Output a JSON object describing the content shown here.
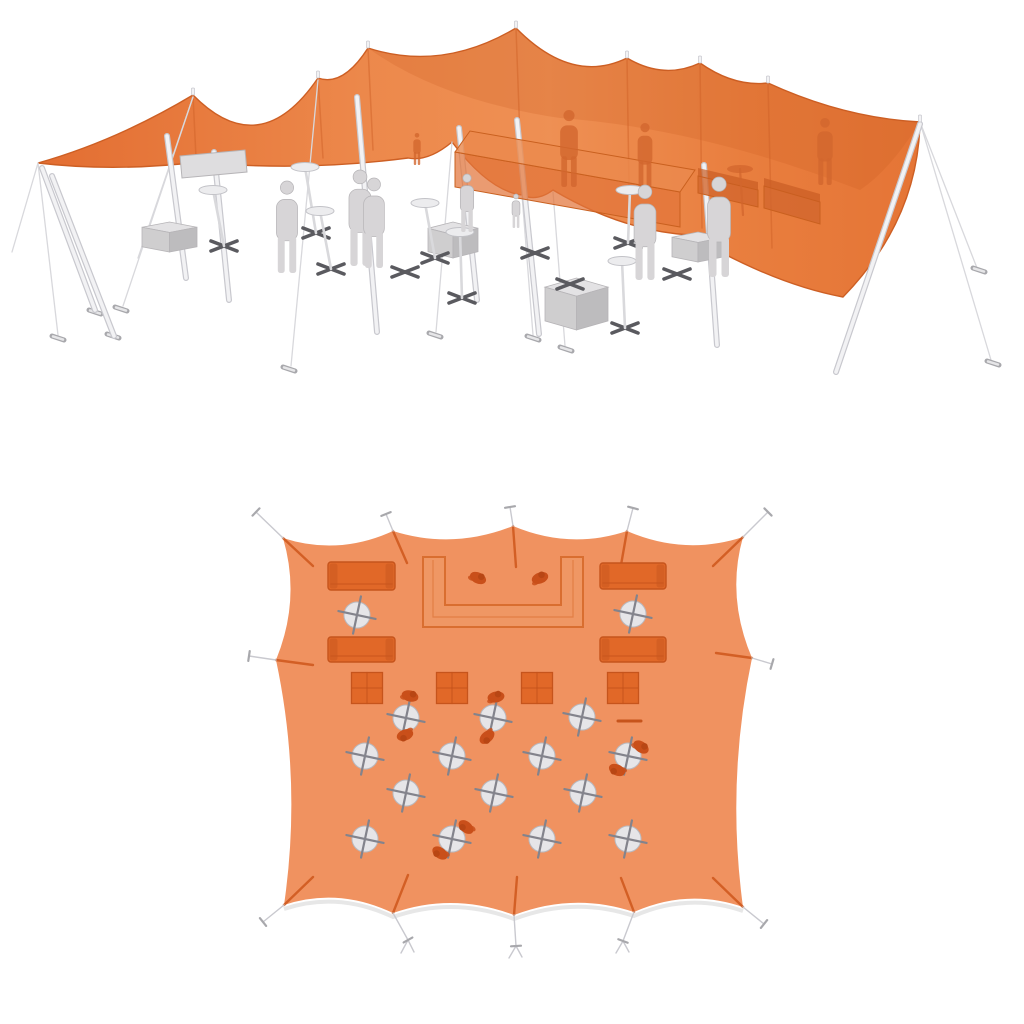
{
  "page": {
    "title": "stretch-tent-renders",
    "background": "#ffffff"
  },
  "colors": {
    "canopy_left": "#e2692b",
    "canopy_mid": "#ee8a4a",
    "canopy_right": "#e87b3a",
    "canopy_edge": "#cd5f24",
    "canopy_band": "#c85c20",
    "fold": "#cf6228",
    "pole_light": "#f2f2f4",
    "pole_dark": "#c8c8ce",
    "rope": "#d8d8dc",
    "stake_dark": "#a8a8ac",
    "stake_light": "#e6e6e8",
    "figure_fill": "#d7d5d7",
    "figure_edge": "#b6b4b7",
    "tint_fill": "#d2662e",
    "table_top": "#ececee",
    "table_edge": "#c2c2c7",
    "xbase": "#5a5a5f",
    "cube_top": "#e3e2e4",
    "cube_front": "#cfcecf",
    "cube_side": "#bdbcbe",
    "bench_fill": "#dedddf",
    "bar_fill": "#e2753a",
    "bar_edge": "#c9601f",
    "plan_fabric": "#f09260",
    "plan_fabric_shadow": "#d7d7d7",
    "plan_furniture": "#e16828",
    "plan_furniture_dark": "#c6541c",
    "plan_person": "#c94f1a",
    "plan_person_dark": "#b84614",
    "plan_table_top": "#e6e5e8",
    "plan_table_edge": "#b9b9bf",
    "plan_cross": "#83838c",
    "plan_seam": "#cf5a1f",
    "plan_rope": "#c9c9cf",
    "plan_ubar_fill": "#ef9764",
    "plan_ubar_edge": "#d96e30"
  },
  "view3d": {
    "canopy": {
      "d": "M 38 163 Q 116 141 193 95 Q 260 163 318 78 Q 343 87 368 48 Q 442 72 516 28 Q 572 85 627 58 Q 664 80 700 63 Q 734 87 768 83 Q 844 118 920 122 Q 918 220 843 297 Q 773 284 690 235 Q 622 231 553 190 Q 537 202 522 195 Q 489 191 452 142 Q 428 162 408 158 Q 300 172 200 162 Q 115 172 38 163 Z",
      "band_d": "M 368 48 Q 442 72 516 28 Q 572 85 627 58 Q 664 80 700 63 Q 734 87 768 83 Q 844 118 920 122 Q 890 170 860 190 Q 700 128 560 118 Q 440 100 368 48 Z"
    },
    "folds": [
      [
        318,
        78,
        323,
        158
      ],
      [
        368,
        48,
        373,
        150
      ],
      [
        516,
        28,
        522,
        193
      ],
      [
        627,
        58,
        629,
        186
      ],
      [
        700,
        63,
        702,
        228
      ],
      [
        768,
        83,
        772,
        248
      ],
      [
        193,
        95,
        196,
        158
      ]
    ],
    "peak_nubs": [
      [
        193,
        93
      ],
      [
        318,
        76
      ],
      [
        368,
        46
      ],
      [
        516,
        26
      ],
      [
        627,
        56
      ],
      [
        700,
        61
      ],
      [
        768,
        81
      ],
      [
        920,
        120
      ]
    ],
    "ropes": [
      [
        38,
        163,
        12,
        252
      ],
      [
        38,
        163,
        58,
        335
      ],
      [
        193,
        97,
        138,
        258
      ],
      [
        193,
        97,
        123,
        306
      ],
      [
        318,
        80,
        291,
        366
      ],
      [
        452,
        142,
        436,
        332
      ],
      [
        522,
        195,
        533,
        335
      ],
      [
        553,
        192,
        565,
        346
      ],
      [
        920,
        122,
        977,
        268
      ],
      [
        920,
        122,
        991,
        360
      ]
    ],
    "stakes": [
      [
        121,
        309
      ],
      [
        289,
        369
      ],
      [
        435,
        335
      ],
      [
        533,
        338
      ],
      [
        566,
        349
      ],
      [
        979,
        270
      ],
      [
        993,
        363
      ],
      [
        95,
        312
      ],
      [
        113,
        336
      ],
      [
        58,
        338
      ]
    ],
    "poles": [
      [
        42,
        168,
        95,
        310
      ],
      [
        52,
        176,
        114,
        336
      ],
      [
        167,
        136,
        186,
        278
      ],
      [
        214,
        152,
        229,
        300
      ],
      [
        357,
        97,
        377,
        332
      ],
      [
        459,
        128,
        477,
        300
      ],
      [
        517,
        120,
        539,
        334
      ],
      [
        704,
        165,
        717,
        345
      ],
      [
        920,
        124,
        836,
        372
      ]
    ],
    "bar": {
      "top": [
        455,
        152,
        470,
        131,
        695,
        170,
        680,
        192
      ],
      "front": [
        455,
        152,
        680,
        192,
        680,
        227,
        455,
        187
      ]
    },
    "sofas": [
      [
        698,
        176,
        758,
        190,
        758,
        207,
        698,
        193
      ],
      [
        764,
        186,
        820,
        202,
        820,
        224,
        764,
        208
      ]
    ],
    "tinted_people": [
      [
        569,
        187,
        77
      ],
      [
        645,
        187,
        64
      ],
      [
        825,
        185,
        67
      ],
      [
        417,
        165,
        32
      ]
    ],
    "tinted_tables": [
      [
        740,
        169,
        743,
        215
      ]
    ],
    "bench": [
      180,
      156,
      245,
      150,
      247,
      172,
      182,
      178
    ],
    "cubes": [
      [
        142,
        222,
        55,
        30
      ],
      [
        428,
        222,
        50,
        36
      ],
      [
        545,
        278,
        63,
        52
      ],
      [
        672,
        232,
        52,
        30
      ]
    ],
    "tables": [
      [
        213,
        190,
        224,
        246
      ],
      [
        305,
        167,
        316,
        233
      ],
      [
        320,
        211,
        331,
        269
      ],
      [
        425,
        203,
        435,
        258
      ],
      [
        460,
        232,
        462,
        298
      ],
      [
        630,
        190,
        628,
        243
      ],
      [
        622,
        261,
        625,
        328
      ]
    ],
    "xbases": [
      [
        535,
        253
      ],
      [
        570,
        284
      ],
      [
        677,
        274
      ],
      [
        405,
        272
      ]
    ],
    "people": [
      [
        287,
        273,
        92
      ],
      [
        360,
        266,
        96
      ],
      [
        374,
        268,
        90
      ],
      [
        467,
        232,
        58
      ],
      [
        645,
        280,
        95
      ],
      [
        719,
        277,
        100
      ],
      [
        516,
        228,
        34
      ]
    ]
  },
  "viewplan": {
    "fabric": {
      "d": "M 283 538 Q 338 556 393 531 Q 453 550 513 526 Q 570 550 627 531 Q 685 556 743 537 Q 726 597 752 658 Q 726 782 743 907 Q 688 888 634 912 Q 574 892 514 915 Q 453 892 393 913 Q 338 887 284 905 Q 302 782 276 660 Q 301 599 283 538 Z",
      "shadow_d": "M 284 909 Q 338 891 393 917 Q 453 896 514 919 Q 574 896 634 916 Q 688 892 743 911"
    },
    "seams": [
      [
        283,
        538,
        313,
        566
      ],
      [
        393,
        531,
        407,
        563
      ],
      [
        513,
        526,
        516,
        567
      ],
      [
        627,
        531,
        621,
        565
      ],
      [
        743,
        537,
        713,
        566
      ],
      [
        276,
        660,
        313,
        665
      ],
      [
        752,
        658,
        716,
        653
      ],
      [
        743,
        907,
        713,
        878
      ],
      [
        634,
        912,
        621,
        878
      ],
      [
        514,
        915,
        517,
        877
      ],
      [
        393,
        913,
        408,
        875
      ],
      [
        284,
        905,
        313,
        877
      ]
    ],
    "ropes": [
      [
        283,
        538,
        256,
        512
      ],
      [
        393,
        531,
        386,
        514
      ],
      [
        513,
        526,
        510,
        507
      ],
      [
        627,
        531,
        633,
        508
      ],
      [
        743,
        537,
        768,
        512
      ],
      [
        276,
        660,
        249,
        656
      ],
      [
        752,
        658,
        772,
        664
      ],
      [
        284,
        905,
        263,
        922
      ],
      [
        393,
        913,
        408,
        940
      ],
      [
        514,
        915,
        516,
        946
      ],
      [
        634,
        912,
        623,
        941
      ],
      [
        743,
        907,
        764,
        924
      ],
      [
        408,
        940,
        401,
        953
      ],
      [
        408,
        940,
        414,
        952
      ],
      [
        516,
        946,
        509,
        958
      ],
      [
        516,
        946,
        522,
        957
      ],
      [
        623,
        941,
        616,
        953
      ],
      [
        623,
        941,
        629,
        952
      ]
    ],
    "ubar": {
      "d": "M 423 557 L 423 627 L 583 627 L 583 557 L 561 557 L 561 605 L 445 605 L 445 557 Z",
      "inner_d": "M 433 560 L 433 617 L 573 617 L 573 560"
    },
    "sofas": [
      [
        328,
        562,
        67,
        28
      ],
      [
        600,
        563,
        66,
        26
      ],
      [
        328,
        637,
        67,
        25
      ],
      [
        600,
        637,
        66,
        25
      ]
    ],
    "sq_tables": [
      [
        367,
        688
      ],
      [
        452,
        688
      ],
      [
        537,
        688
      ],
      [
        623,
        688
      ]
    ],
    "sq_size": 31,
    "round_tables": [
      [
        357,
        615
      ],
      [
        633,
        614
      ],
      [
        406,
        718
      ],
      [
        493,
        718
      ],
      [
        582,
        717
      ],
      [
        365,
        756
      ],
      [
        452,
        756
      ],
      [
        542,
        756
      ],
      [
        628,
        756
      ],
      [
        406,
        793
      ],
      [
        494,
        793
      ],
      [
        583,
        793
      ],
      [
        365,
        839
      ],
      [
        452,
        839
      ],
      [
        542,
        839
      ],
      [
        628,
        839
      ]
    ],
    "round_radius": 13,
    "people": [
      [
        478,
        578,
        25
      ],
      [
        540,
        578,
        -20
      ],
      [
        410,
        696,
        15
      ],
      [
        496,
        697,
        -10
      ],
      [
        405,
        735,
        160
      ],
      [
        487,
        737,
        140
      ],
      [
        641,
        747,
        35
      ],
      [
        617,
        770,
        205
      ],
      [
        466,
        827,
        220
      ],
      [
        440,
        853,
        215
      ]
    ],
    "dash": [
      618,
      721,
      641,
      721
    ]
  }
}
